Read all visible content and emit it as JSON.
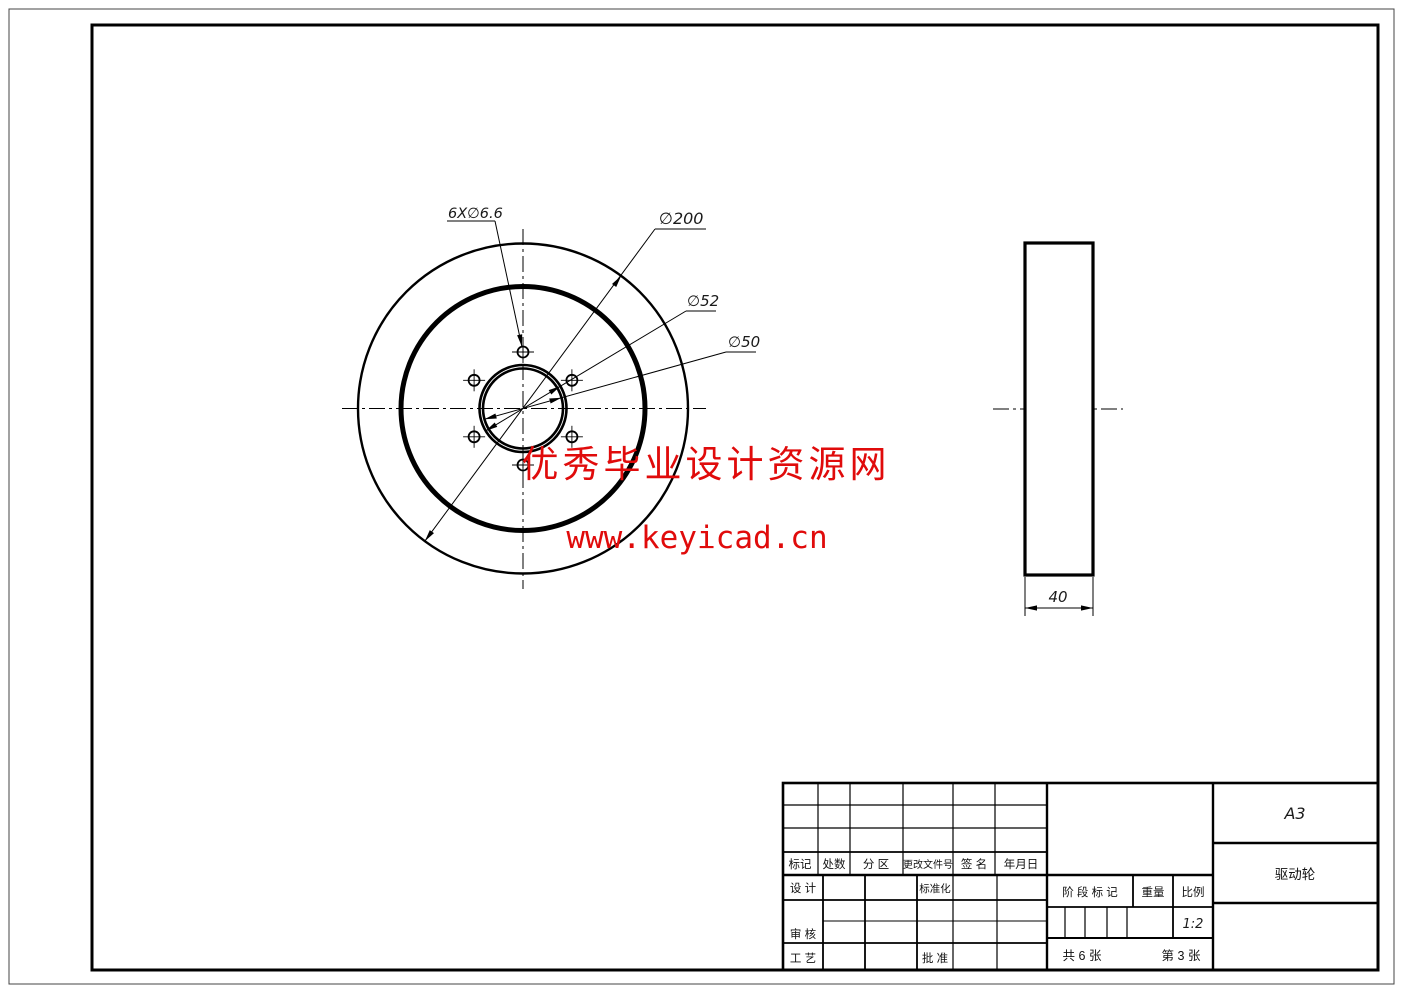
{
  "drawing": {
    "front_view": {
      "dim_bolt_holes": "6X∅6.6",
      "dim_outer_diameter": "∅200",
      "dim_hub_diameter": "∅52",
      "dim_bore_diameter": "∅50"
    },
    "side_view": {
      "dim_thickness": "40"
    }
  },
  "watermark": {
    "site_name": "优秀毕业设计资源网",
    "site_url": "www.keyicad.cn",
    "color": "#e00b0b"
  },
  "title_block": {
    "revision_columns": [
      "标记",
      "处数",
      "分 区",
      "更改文件号",
      "签 名",
      "年月日"
    ],
    "design_label": "设 计",
    "standardization_label": "标准化",
    "check_label": "审 核",
    "process_label": "工 艺",
    "approve_label": "批 准",
    "stage_mark_label": "阶 段 标 记",
    "weight_label": "重量",
    "scale_label": "比例",
    "scale_value": "1:2",
    "sheets_total": "共 6 张",
    "sheet_number": "第 3 张",
    "paper_size": "A3",
    "part_name": "驱动轮"
  }
}
